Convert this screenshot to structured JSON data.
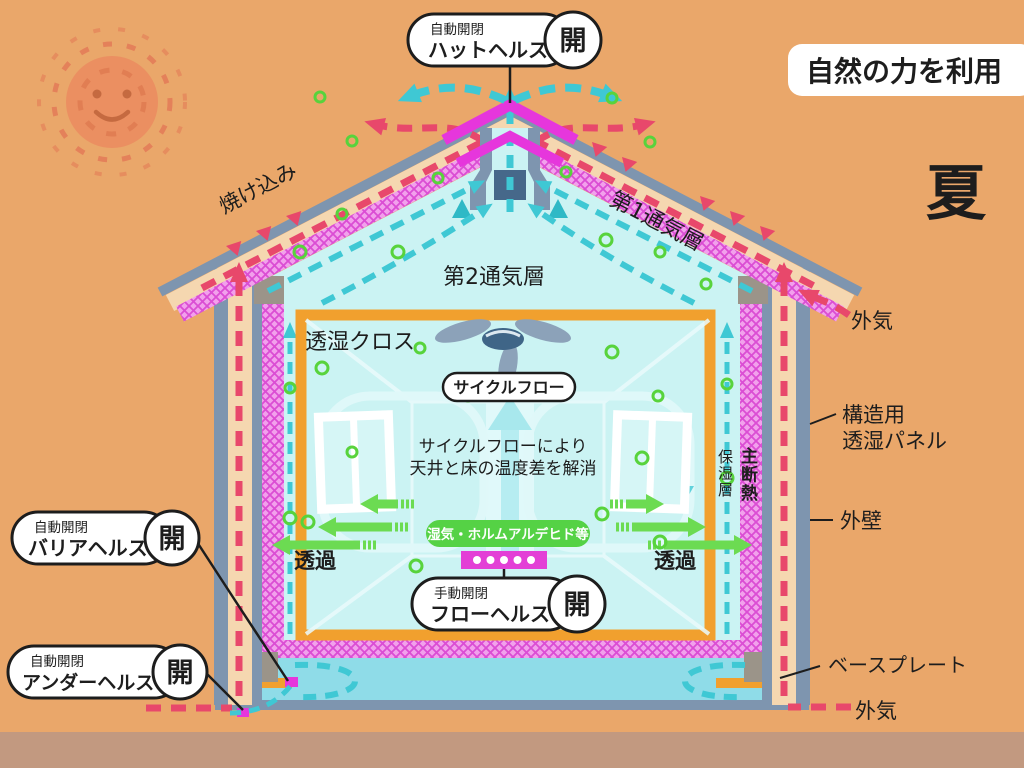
{
  "header": {
    "badge": "自然の力を利用",
    "season": "夏"
  },
  "devices": {
    "hat": {
      "mode": "自動開閉",
      "name": "ハットヘルス",
      "state": "開"
    },
    "barrier": {
      "mode": "自動開閉",
      "name": "バリアヘルス",
      "state": "開"
    },
    "under": {
      "mode": "自動開閉",
      "name": "アンダーヘルス",
      "state": "開"
    },
    "flow": {
      "mode": "手動開閉",
      "name": "フローヘルス",
      "state": "開"
    }
  },
  "labels": {
    "yakekomi": "焼け込み",
    "air_layer_1": "第1通気層",
    "air_layer_2": "第2通気層",
    "outside_air_top": "外気",
    "outside_air_bottom": "外気",
    "structural_panel_1": "構造用",
    "structural_panel_2": "透湿パネル",
    "outer_wall": "外壁",
    "moisture_retention_layer": "保湿層",
    "main_insulation": "主断熱",
    "permeable_cloth": "透湿クロス",
    "cycle_flow": "サイクルフロー",
    "cycle_flow_desc_1": "サイクルフローにより",
    "cycle_flow_desc_2": "天井と床の温度差を解消",
    "moisture_formaldehyde": "湿気・ホルムアルデヒド等",
    "permeate_left": "透過",
    "permeate_right": "透過",
    "base_plate": "ベースプレート"
  },
  "colors": {
    "background": "#EAA76A",
    "ground": "#C29980",
    "warm_flow_red": "#E8486B",
    "cool_flow_cyan": "#3FC8D4",
    "interior_cyan": "#CBF3F3",
    "insulation_magenta": "#E636DC",
    "cloth_frame_orange": "#F1A02E",
    "structure_slate": "#7E95AF",
    "wall_tan": "#F5D7B0",
    "green": "#6CDB52",
    "state_open_gray": "#9FACB5"
  }
}
